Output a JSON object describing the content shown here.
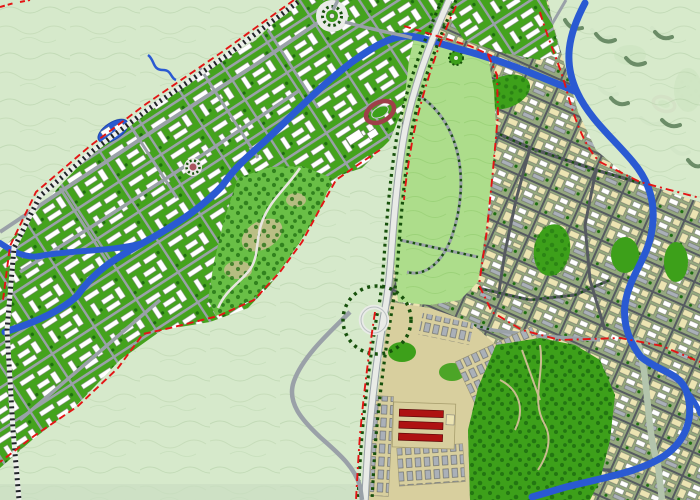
{
  "map": {
    "type": "urban-master-plan-rendering",
    "description_names": [
      "terrain",
      "contours",
      "new-town-corridor",
      "greenbelt-park",
      "old-city",
      "rivers",
      "railway",
      "boundaries",
      "stadium",
      "roundabout",
      "interchange",
      "rowhouses"
    ],
    "palette": {
      "terrain": "#d6e9cb",
      "terrainContour": "#b7d2aa",
      "bottomBand": "#c9ddc2",
      "corridorGreen": "#44a31d",
      "blockGreen": "#3da01a",
      "forestDark": "#1e6e10",
      "parkLight": "#addd8b",
      "parkTexture": "#97cf74",
      "hillGreen": "#69bf46",
      "roadGray": "#9aa1a8",
      "roadDark": "#565a60",
      "roadWhite": "#e9ebe7",
      "roadSage": "#b3c4ac",
      "railDark": "#202428",
      "railCasing": "#eceeea",
      "water": "#2a5ad2",
      "waterDeep": "#1f47b0",
      "boundaryRed": "#e31515",
      "buildingWhite": "#ffffff",
      "buildingBeige": "#ece4b2",
      "buildingGray": "#aab0b8",
      "buildingRed": "#ae1212",
      "trackRed": "#9e4049",
      "treeLine": "#17510c",
      "shadowOlive": "#5a7d57",
      "tanPath": "#c9bd90",
      "beigeZone": "#d8cf9e",
      "cityBase": "#95a87e"
    },
    "features": [
      {
        "id": "roundabout-plaza",
        "center": [
          332,
          16
        ]
      },
      {
        "id": "stadium-oval",
        "center": [
          380,
          112
        ]
      },
      {
        "id": "small-circular-stadium",
        "center": [
          193,
          167
        ]
      },
      {
        "id": "city-stadium",
        "center": [
          664,
          104
        ]
      },
      {
        "id": "lake",
        "center": [
          113,
          131
        ]
      },
      {
        "id": "highway-interchange",
        "center": [
          377,
          320
        ]
      },
      {
        "id": "park-roundabout",
        "center": [
          456,
          58
        ]
      },
      {
        "id": "red-rowhouse-block",
        "center": [
          424,
          424
        ]
      }
    ]
  }
}
